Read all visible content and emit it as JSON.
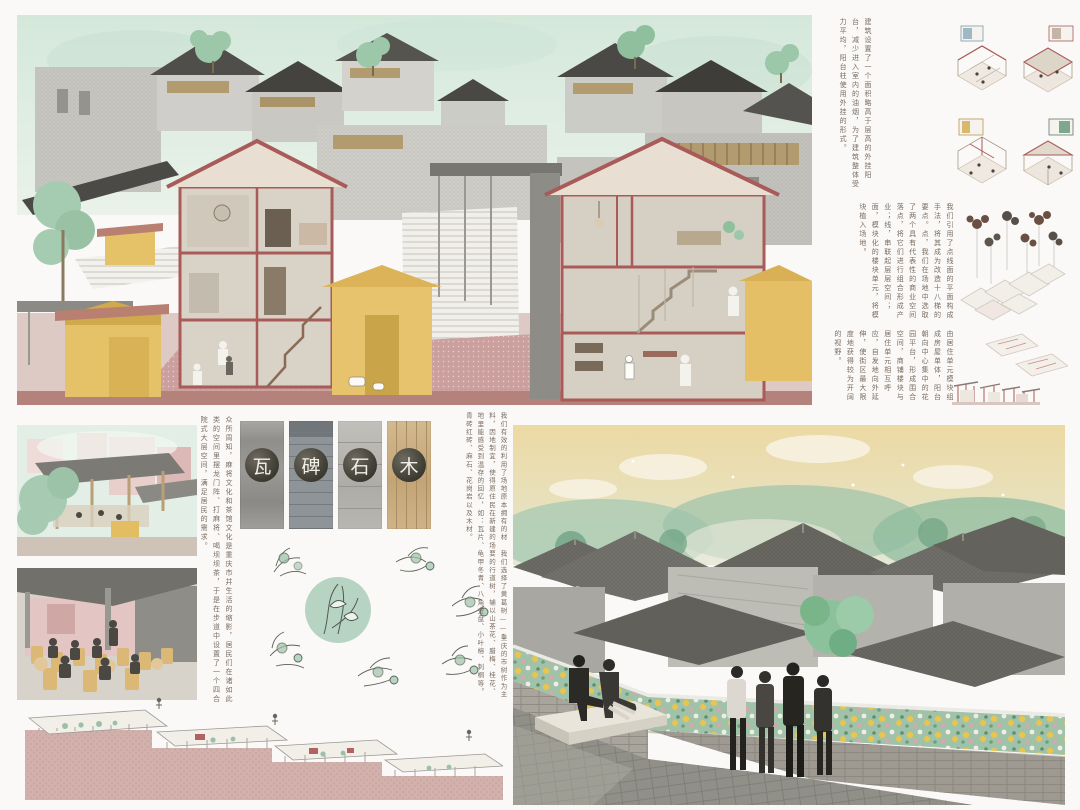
{
  "palette": {
    "board_bg": "#faf9f7",
    "sky_mint": "#d7e9dd",
    "section_red": "#a85b58",
    "ground_rose": "#b5817b",
    "plaza_pink": "#ddc9c4",
    "stall_yellow": "#e5c168",
    "tree_green": "#9cc7a8",
    "render_sky": "#ecdaa6",
    "roof_gray": "#6e6d67",
    "planter_green": "#9fc2a8",
    "flower_yellow": "#e9c44f"
  },
  "notes": {
    "balcony": "建筑设置了一个面积略高于层高的外挂阳台，减少进入室内的油烟，为了建筑整体受力平均，阳台柱使用外挂的形式。",
    "composition": "我们引用了点线面的平面构成手法，将其成为改造十八梯的要点。点，我们在场地中选取了两个具有代表性的商业空间落点，将它们进行组合形成产业；线，串联起层层空间；面，模块化的楼块单元，将模块植入场地。",
    "units": "由居住单元模块组成房屋单体，阳台朝向中心集中的花园平台，形成围合空间，商铺楼块与居住单元相互呼应，自发地向外延伸，使街区最大限度地获得较为开阔的视野。",
    "teahouse": "众所周知，麻将文化和茶馆文化是重庆市井生活的缩影，居民们在诸如此类的空间里摆龙门阵、打麻将、喝坝坝茶，于是在步道中设置了一个四合院式大层空间，满足居民的需求。",
    "materials": "我们有效的利用了场地原本拥有的材料，因地制宜，使得原住民在新建的场地里能感受到温存的回忆，如：瓦片、青砖红砖、麻石、花岗岩以及木材。",
    "planting": "我们选择了黄葛树——重庆的市树作为主要的行道树，辅以山茶花、腊梅、桂花、龟甲冬青、八角金盘、小叶榕、刺桐等。"
  },
  "materials": {
    "items": [
      {
        "char": "瓦",
        "label": "tile"
      },
      {
        "char": "碑",
        "label": "stele-brick"
      },
      {
        "char": "石",
        "label": "stone"
      },
      {
        "char": "木",
        "label": "wood"
      }
    ]
  }
}
